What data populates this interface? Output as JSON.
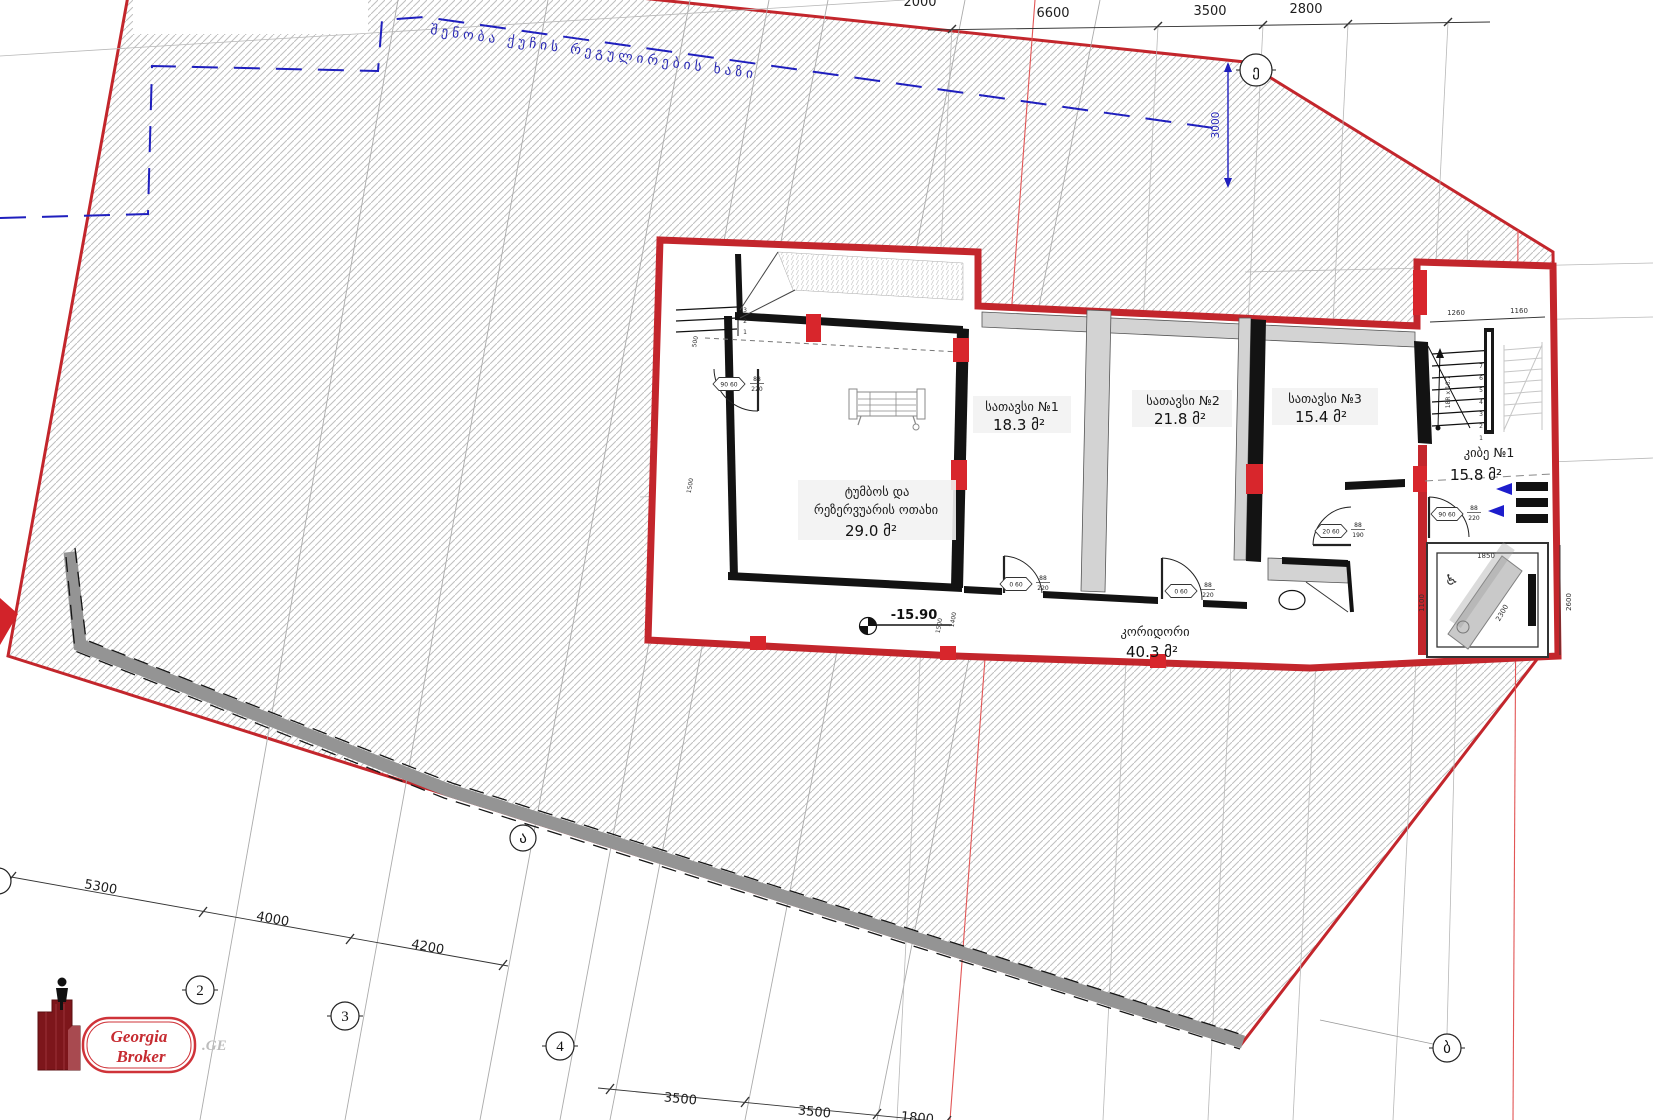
{
  "rooms": {
    "storage1": {
      "name": "სათავსი №1",
      "area": "18.3 მ²"
    },
    "storage2": {
      "name": "სათავსი №2",
      "area": "21.8 მ²"
    },
    "storage3": {
      "name": "სათავსი  №3",
      "area": "15.4 მ²"
    },
    "pump": {
      "line1": "ტუმბოს და",
      "line2": "რეზერვუარის ოთახი",
      "area": "29.0 მ²"
    },
    "stair": {
      "name": "კიბე №1",
      "area": "15.8 მ²"
    },
    "corridor": {
      "name": "კორიდორი",
      "area": "40.3 მ²"
    }
  },
  "site": {
    "regulation_line_label": "შენობა ქუჩის რეგულირების ხაზი",
    "elevation": "-15.90"
  },
  "dims": {
    "top": [
      "2000",
      "6600",
      "3500",
      "2800"
    ],
    "offset": "3000",
    "left": [
      "5300",
      "4000",
      "4200"
    ],
    "bottom": [
      "3500",
      "3500",
      "1800"
    ],
    "stair": {
      "w1": "1260",
      "w2": "1160",
      "note": "18R x 16.7"
    },
    "elevator": [
      "1850",
      "1100",
      "2300",
      "2600"
    ],
    "misc": [
      "1500",
      "1500",
      "1400",
      "500"
    ]
  },
  "grid": {
    "n2": "2",
    "n3": "3",
    "n4": "4",
    "ga": "ა",
    "gb": "ბ",
    "ge": "ე"
  },
  "stairs": {
    "steps": [
      "1",
      "2",
      "3",
      "4",
      "5",
      "6",
      "7"
    ]
  },
  "ramp": {
    "steps": [
      "1",
      "2",
      "3"
    ]
  },
  "doors": {
    "d1": {
      "tag": "90 60",
      "num": "88",
      "den": "220"
    },
    "d2": {
      "tag": "0 60",
      "num": "88",
      "den": "220"
    },
    "d3": {
      "tag": "0 60",
      "num": "88",
      "den": "220"
    },
    "d4": {
      "tag": "20 60",
      "num": "88",
      "den": "190"
    },
    "d5": {
      "tag": "90 60",
      "num": "88",
      "den": "220"
    }
  },
  "icons": {
    "wheelchair": "♿"
  },
  "logo": {
    "line1": "Georgia",
    "line2": "Broker",
    "suffix": ".GE"
  },
  "colors": {
    "boundary": "#c3262c",
    "patch": "#d8262c",
    "blue": "#1f1fbe",
    "hatch": "#c0c0c0"
  }
}
